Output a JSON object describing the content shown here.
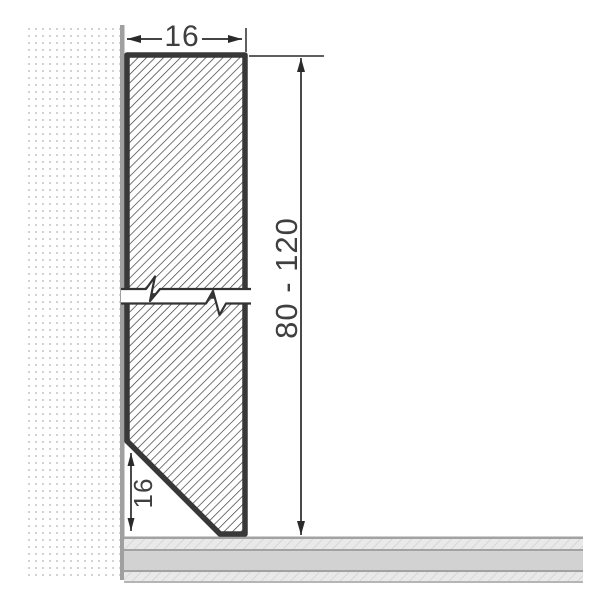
{
  "diagram": {
    "type": "technical-drawing",
    "subject": "skirting-board-profile-cross-section",
    "dimensions": {
      "top_width": {
        "label": "16"
      },
      "height_range": {
        "label": "80 - 120"
      },
      "bottom_chamfer": {
        "label": "16"
      }
    },
    "colors": {
      "background": "#ffffff",
      "outline": "#383838",
      "hatch_line": "#3a3a3a",
      "wall_dot": "#d2d2d2",
      "wall_edge_strip": "#a0a0a0",
      "floor_border": "#a2a2a2",
      "floor_band_solid": "#d2d2d2",
      "floor_band_hatch_bg": "#e9e9e9",
      "floor_band_hatch_line": "#cdcdcd",
      "dimension_line": "#2a2a2a",
      "text": "#3f3f3f"
    }
  }
}
